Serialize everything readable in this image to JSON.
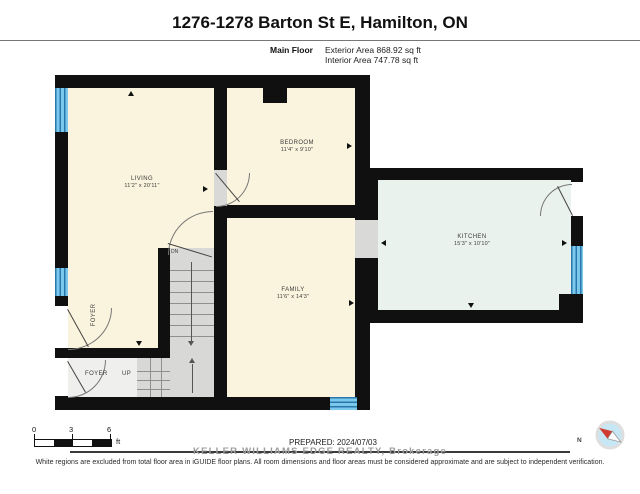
{
  "header": {
    "title": "1276-1278 Barton St E, Hamilton, ON",
    "floor_label": "Main Floor",
    "exterior_area": "Exterior Area 868.92 sq ft",
    "interior_area": "Interior Area 747.78 sq ft"
  },
  "rooms": {
    "living": {
      "name": "LIVING",
      "dims": "11'2\" x 20'11\""
    },
    "bedroom": {
      "name": "BEDROOM",
      "dims": "11'4\" x 9'10\""
    },
    "kitchen": {
      "name": "KITCHEN",
      "dims": "15'3\" x 10'10\""
    },
    "family": {
      "name": "FAMILY",
      "dims": "11'6\" x 14'3\""
    },
    "foyer_side": {
      "name": "FOYER"
    },
    "foyer_entry": {
      "name": "FOYER"
    }
  },
  "labels": {
    "up": "UP",
    "dn": "DN"
  },
  "scale": {
    "start": "0",
    "mid": "3",
    "end": "6",
    "unit": "ft"
  },
  "footer": {
    "prepared": "PREPARED: 2024/07/03",
    "watermark": "KELLER WILLIAMS EDGE REALTY, Brokerage",
    "disclaimer": "White regions are excluded from total floor area in iGUIDE floor plans. All room dimensions and floor areas must be considered approximate and are subject to independent verification."
  },
  "compass": {
    "north": "N"
  },
  "colors": {
    "wall": "#101010",
    "room_cream": "#faf3dd",
    "room_mint": "#e9f2ec",
    "stairs_gray": "#d8d8d7",
    "window_blue": "#7cc8ec",
    "window_stripe": "#2878ad",
    "compass_fill": "#c7e7f5",
    "compass_needle_red": "#cf3b30"
  }
}
